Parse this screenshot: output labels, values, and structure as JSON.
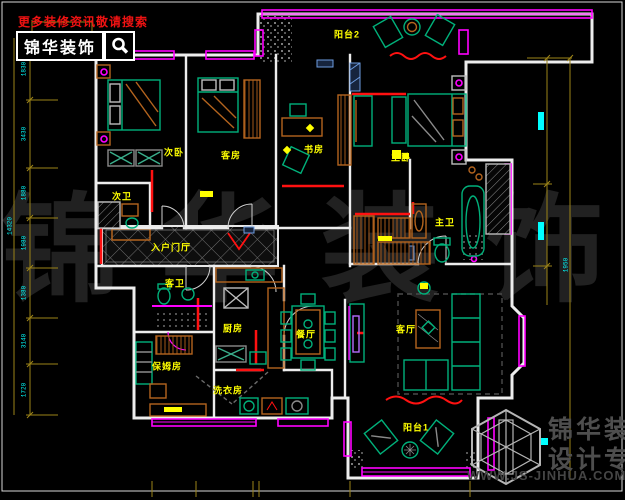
{
  "header": {
    "search_hint": "更多装修资讯敬请搜索",
    "brand": "锦华装饰",
    "search_icon": "magnifier-icon"
  },
  "footer": {
    "brand_line1": "锦华装饰",
    "brand_line2": "设计专家",
    "website": "WWW.JS-JINHUA.COM",
    "logo": "cube-logo"
  },
  "watermark": {
    "chars": [
      "锦",
      "华",
      "装",
      "饰"
    ]
  },
  "floorplan": {
    "room_labels": [
      {
        "id": "balcony-2",
        "text": "阳台2",
        "x": 347,
        "y": 34
      },
      {
        "id": "secondary-bedroom",
        "text": "次卧",
        "x": 174,
        "y": 152
      },
      {
        "id": "guest-room",
        "text": "客房",
        "x": 231,
        "y": 155
      },
      {
        "id": "study",
        "text": "书房",
        "x": 314,
        "y": 149
      },
      {
        "id": "master-bedroom",
        "text": "主卧",
        "x": 401,
        "y": 157
      },
      {
        "id": "secondary-bath",
        "text": "次卫",
        "x": 122,
        "y": 196
      },
      {
        "id": "master-bath",
        "text": "主卫",
        "x": 445,
        "y": 222
      },
      {
        "id": "entry-hall",
        "text": "入户门厅",
        "x": 171,
        "y": 247
      },
      {
        "id": "guest-bath",
        "text": "客卫",
        "x": 175,
        "y": 283
      },
      {
        "id": "kitchen",
        "text": "厨房",
        "x": 233,
        "y": 328
      },
      {
        "id": "nanny-room",
        "text": "保姆房",
        "x": 167,
        "y": 366
      },
      {
        "id": "laundry",
        "text": "洗衣房",
        "x": 228,
        "y": 390
      },
      {
        "id": "dining-room",
        "text": "餐厅",
        "x": 306,
        "y": 334
      },
      {
        "id": "living-room",
        "text": "客厅",
        "x": 406,
        "y": 329
      },
      {
        "id": "balcony-1",
        "text": "阳台1",
        "x": 416,
        "y": 427
      }
    ]
  },
  "dimensions": {
    "left_overall": "14320",
    "left_chain": [
      "1830",
      "3430",
      "1880",
      "1980",
      "1380",
      "3140",
      "1720"
    ],
    "right_value": "1950"
  },
  "colors": {
    "background": "#000000",
    "wall": "#ededed",
    "window_magenta": "#ff00ff",
    "furniture_green": "#00b07a",
    "cabinet_orange": "#b4641e",
    "label_yellow": "#ffff00",
    "dimension_olive": "#9c8418",
    "dimension_cyan": "#00ffff",
    "accent_red": "#ff1111",
    "hint_red": "#f01212",
    "watermark_gray": "#212121",
    "logo_gray": "#4e4e4e",
    "sill_blue": "#6d9ce0"
  }
}
